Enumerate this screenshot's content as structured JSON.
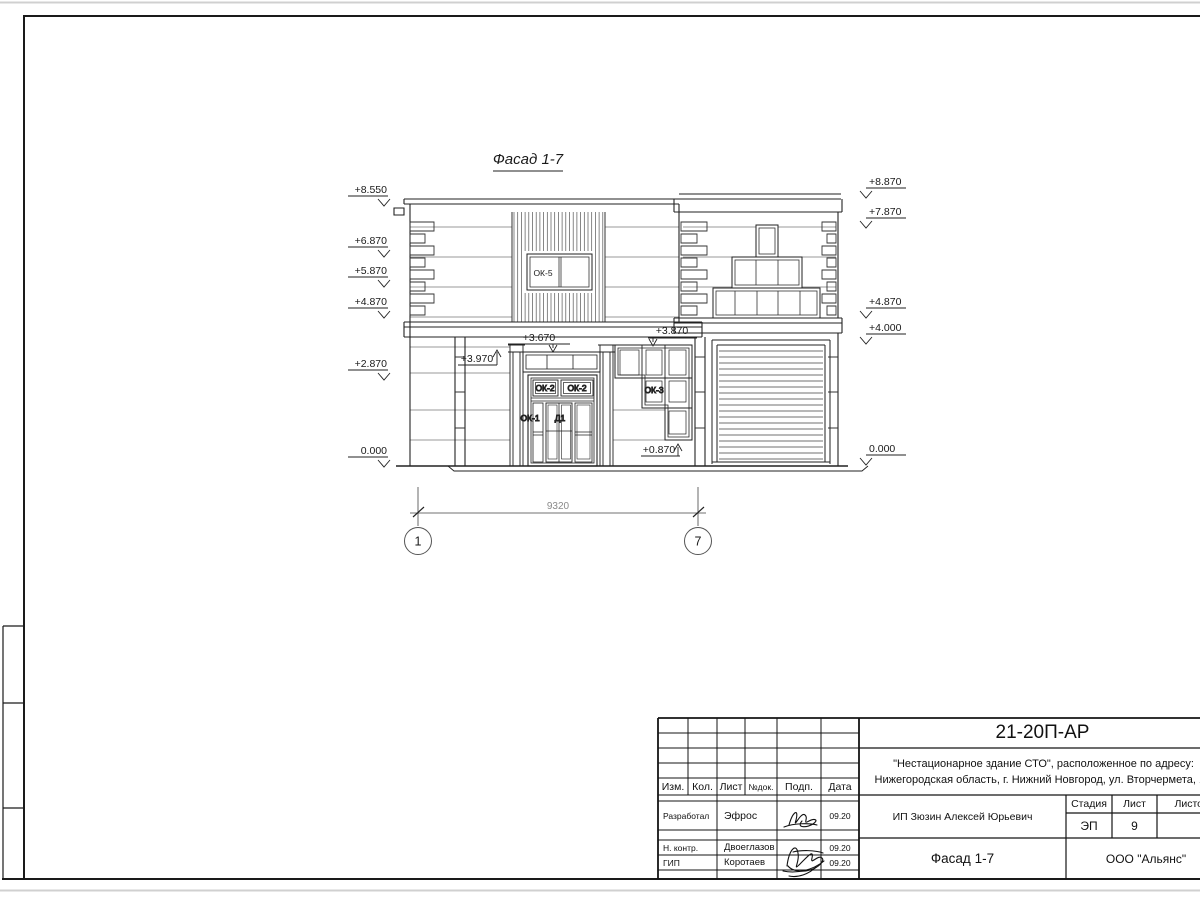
{
  "drawing": {
    "title": "Фасад 1-7",
    "marks_left": [
      "+8.550",
      "+6.870",
      "+5.870",
      "+4.870",
      "+2.870",
      "0.000"
    ],
    "marks_right": [
      "+8.870",
      "+7.870",
      "+4.870",
      "+4.000",
      "0.000"
    ],
    "marks_inline": {
      "pilaster": "+3.970",
      "transom": "+3.670",
      "ok3_top": "+3.870",
      "ok3_bottom": "+0.870"
    },
    "labels": {
      "ok5": "ОК-5",
      "ok2a": "ОК-2",
      "ok2b": "ОК-2",
      "ok3": "ОК-3",
      "ok1": "ОК-1",
      "d1": "Д1"
    },
    "dimension": {
      "value": "9320",
      "axis_left": "1",
      "axis_right": "7"
    }
  },
  "title_block": {
    "doc_number": "21-20П-АР",
    "project_line1": "\"Нестационарное здание СТО\", расположенное по адресу:",
    "project_line2": "Нижегородская область, г. Нижний Новгород, ул. Вторчермета, 1А",
    "columns": {
      "izm": "Изм.",
      "kol": "Кол.",
      "list": "Лист",
      "ndok": "№док.",
      "podp": "Подп.",
      "data": "Дата"
    },
    "rows": [
      {
        "role": "Разработал",
        "name": "Эфрос",
        "date": "09.20"
      },
      {
        "role": "Н. контр.",
        "name": "Двоеглазов",
        "date": "09.20"
      },
      {
        "role": "ГИП",
        "name": "Коротаев",
        "date": "09.20"
      }
    ],
    "client": "ИП Зюзин Алексей Юрьевич",
    "stage_label": "Стадия",
    "sheet_label": "Лист",
    "sheets_label": "Листов",
    "stage_value": "ЭП",
    "sheet_value": "9",
    "sheet_title": "Фасад 1-7",
    "company": "ООО \"Альянс\""
  }
}
